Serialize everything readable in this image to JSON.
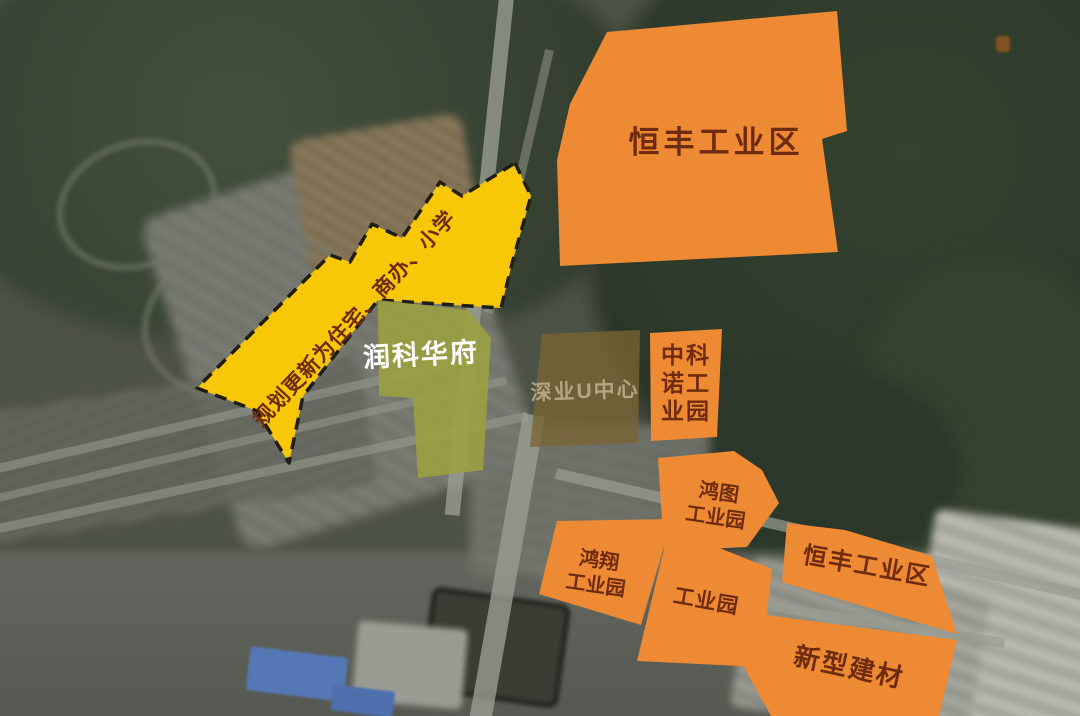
{
  "colors": {
    "zone_orange": "#ED8A33",
    "zone_yellow": "#F7C708",
    "zone_olive": "#9CA23F",
    "zone_brown": "#7A6433",
    "label_dark": "#6F2B10",
    "label_white": "#FFFFFF",
    "label_faint": "#E7DFC8",
    "dash_black": "#201D15"
  },
  "regions": {
    "hengfeng_top": {
      "label": "恒丰工业区"
    },
    "planning_arrow": {
      "label": "规划更新为住宅、商办、小学"
    },
    "runke_huafu": {
      "label": "润科华府"
    },
    "shenye_u_center": {
      "label": "深业U中心"
    },
    "zhongkenuo": {
      "line1": "中科",
      "line2": "诺工",
      "line3": "业园"
    },
    "hongtu": {
      "line1": "鸿图",
      "line2": "工业园"
    },
    "hongxiang": {
      "line1": "鸿翔",
      "line2": "工业园"
    },
    "gongyeyuan": {
      "label": "工业园"
    },
    "hengfeng_right": {
      "label": "恒丰工业区"
    },
    "xinxing_jiancai": {
      "label": "新型建材"
    }
  }
}
